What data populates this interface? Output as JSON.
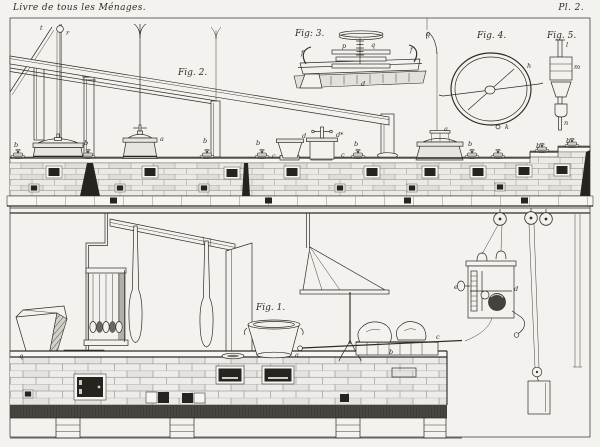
{
  "plate": {
    "book_title": "Livre de tous les Ménages.",
    "plate_number": "Pl. 2.",
    "colors": {
      "paper": "#f3f2ee",
      "ink": "#2e2c27",
      "margin": "#e6e4df",
      "dark_opening": "#26241f"
    }
  },
  "figure_labels": [
    {
      "text": "Fig. 2.",
      "x": 178,
      "y": 75
    },
    {
      "text": "Fig: 3.",
      "x": 295,
      "y": 36
    },
    {
      "text": "Fig. 4.",
      "x": 477,
      "y": 38
    },
    {
      "text": "Fig. 5.",
      "x": 547,
      "y": 38
    },
    {
      "text": "Fig. 1.",
      "x": 256,
      "y": 310
    }
  ],
  "callout_letters": [
    {
      "t": "t",
      "x": 40,
      "y": 30
    },
    {
      "t": "r",
      "x": 66,
      "y": 35
    },
    {
      "t": "q",
      "x": 426,
      "y": 36
    },
    {
      "t": "b",
      "x": 14,
      "y": 147
    },
    {
      "t": "b",
      "x": 84,
      "y": 145
    },
    {
      "t": "a",
      "x": 160,
      "y": 141
    },
    {
      "t": "b",
      "x": 203,
      "y": 143
    },
    {
      "t": "b",
      "x": 256,
      "y": 145
    },
    {
      "t": "d",
      "x": 302,
      "y": 138
    },
    {
      "t": "d*",
      "x": 336,
      "y": 137
    },
    {
      "t": "c",
      "x": 272,
      "y": 158
    },
    {
      "t": "c",
      "x": 341,
      "y": 157
    },
    {
      "t": "b",
      "x": 354,
      "y": 146
    },
    {
      "t": "a",
      "x": 444,
      "y": 131
    },
    {
      "t": "b",
      "x": 468,
      "y": 146
    },
    {
      "t": "b",
      "x": 536,
      "y": 148
    },
    {
      "t": "b",
      "x": 566,
      "y": 143
    },
    {
      "t": "f",
      "x": 301,
      "y": 55
    },
    {
      "t": "p",
      "x": 342,
      "y": 48
    },
    {
      "t": "q",
      "x": 371,
      "y": 47
    },
    {
      "t": "f",
      "x": 410,
      "y": 52
    },
    {
      "t": "d",
      "x": 361,
      "y": 86
    },
    {
      "t": "h",
      "x": 527,
      "y": 68
    },
    {
      "t": "k",
      "x": 505,
      "y": 129
    },
    {
      "t": "l",
      "x": 566,
      "y": 47
    },
    {
      "t": "m",
      "x": 574,
      "y": 69
    },
    {
      "t": "n",
      "x": 564,
      "y": 125
    },
    {
      "t": "q",
      "x": 19,
      "y": 358
    },
    {
      "t": "a",
      "x": 295,
      "y": 357
    },
    {
      "t": "b",
      "x": 389,
      "y": 354
    },
    {
      "t": "c",
      "x": 436,
      "y": 339
    },
    {
      "t": "d",
      "x": 514,
      "y": 291
    },
    {
      "t": "e",
      "x": 454,
      "y": 289
    }
  ]
}
